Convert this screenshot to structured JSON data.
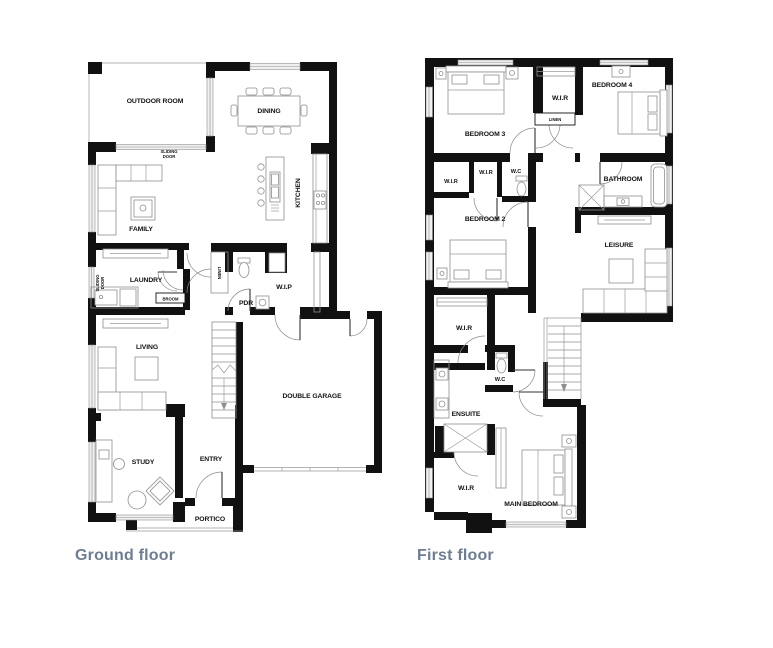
{
  "colors": {
    "wall": "#111111",
    "window_fill": "#f0f0f0",
    "window_stroke": "#8f8f8f",
    "furniture_stroke": "#8f8f8f",
    "caption": "#6e7e92",
    "label": "#111111"
  },
  "ground_floor": {
    "caption": "Ground floor",
    "labels": {
      "outdoor_room": "OUTDOOR ROOM",
      "dining": "DINING",
      "kitchen": "KITCHEN",
      "family": "FAMILY",
      "sliding_door_top_line1": "SLIDING",
      "sliding_door_top_line2": "DOOR",
      "sliding_door_left_line1": "SLIDING",
      "sliding_door_left_line2": "DOOR",
      "laundry": "LAUNDRY",
      "broom": "BROOM",
      "linen": "LINEN",
      "pdr": "PDR",
      "wip": "W.I.P",
      "living": "LIVING",
      "double_garage": "DOUBLE GARAGE",
      "study": "STUDY",
      "entry": "ENTRY",
      "portico": "PORTICO"
    }
  },
  "first_floor": {
    "caption": "First floor",
    "labels": {
      "bedroom_3": "BEDROOM 3",
      "wir_bed4": "W.I.R",
      "linen": "LINEN",
      "bedroom_4": "BEDROOM 4",
      "wir_bed2_a": "W.I.R",
      "wir_bed2_b": "W.I.R",
      "wc_upper": "W.C",
      "bathroom": "BATHROOM",
      "bedroom_2": "BEDROOM 2",
      "leisure": "LEISURE",
      "wir_main_upper": "W.I.R",
      "wc_lower": "W.C",
      "ensuite": "ENSUITE",
      "wir_main_lower": "W.I.R",
      "main_bedroom": "MAIN BEDROOM"
    }
  }
}
